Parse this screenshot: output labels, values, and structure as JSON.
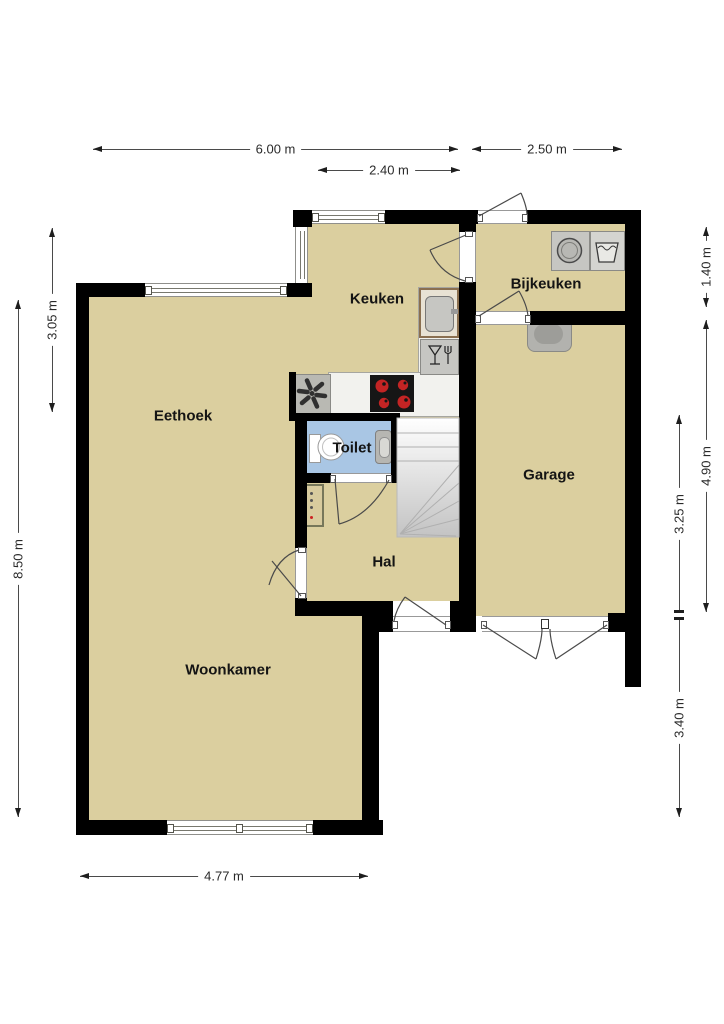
{
  "title": "Begane grond plattegrond",
  "rooms": {
    "eethoek": "Eethoek",
    "keuken": "Keuken",
    "bijkeuken": "Bijkeuken",
    "garage": "Garage",
    "toilet": "Toilet",
    "hal": "Hal",
    "woonkamer": "Woonkamer"
  },
  "dims": {
    "d600": "6.00 m",
    "d250": "2.50 m",
    "d240": "2.40 m",
    "d477": "4.77 m",
    "d850": "8.50 m",
    "d305": "3.05 m",
    "d140": "1.40 m",
    "d490": "4.90 m",
    "d325": "3.25 m",
    "d340": "3.40 m"
  },
  "colors": {
    "wall": "#000000",
    "floor": "#dbcf9f",
    "toilet_floor": "#a9c6e4",
    "hob_burner": "#c32424",
    "dimension_text": "#2a2a2a"
  },
  "icons": {
    "washing_machine": "washing-machine-icon",
    "laundry_tub": "laundry-tub-icon",
    "kitchen_sink": "kitchen-sink-icon",
    "dishwasher": "dishwasher-icon",
    "cooktop": "cooktop-icon",
    "extractor_fan": "extractor-fan-icon",
    "toilet_fixture": "toilet-icon",
    "hand_basin": "hand-basin-icon",
    "radiator": "radiator-icon",
    "garage_sink": "garage-sink-icon",
    "stairs": "stairs-icon"
  }
}
